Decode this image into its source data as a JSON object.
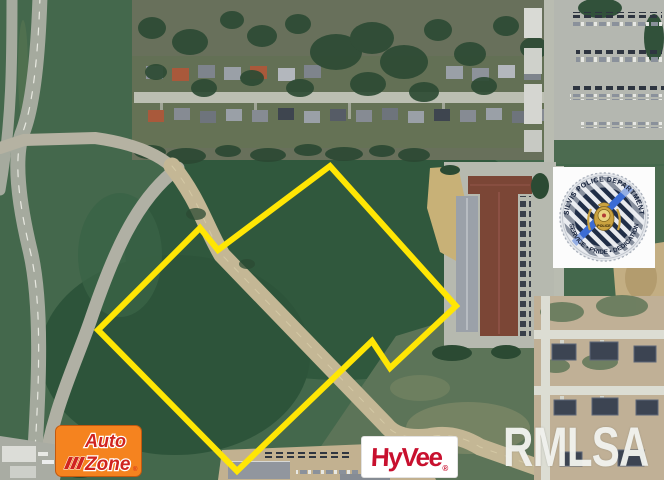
{
  "parcel": {
    "points": "330,166 456,306 390,368 372,341 237,471 98,330 200,228 218,250",
    "vertices": [
      [
        330,
        166
      ],
      [
        456,
        306
      ],
      [
        390,
        368
      ],
      [
        372,
        341
      ],
      [
        237,
        471
      ],
      [
        98,
        330
      ],
      [
        200,
        228
      ],
      [
        218,
        250
      ]
    ],
    "stroke_color": "#ffe604",
    "stroke_width": "6"
  },
  "watermarks": {
    "rmlsa": "RMLSA"
  },
  "logos": {
    "autozone": {
      "line1": "Auto",
      "line2": "Zone",
      "reg": "®",
      "bg_color": "#f5831f",
      "text_color": "#d0241f"
    },
    "hyvee": {
      "text": "HyVee",
      "reg": "®",
      "bg_color": "#ffffff",
      "text_color": "#c8102e"
    }
  },
  "police_seal": {
    "top_arc": "SILVIS POLICE DEPARTMENT",
    "bottom_arc": "SERVICE • PRIDE • DEDICATION",
    "center_label": "POLICE",
    "stripe_dark": "#202e47",
    "stripe_blue": "#3b6cd4",
    "gold": "#caa23f"
  }
}
